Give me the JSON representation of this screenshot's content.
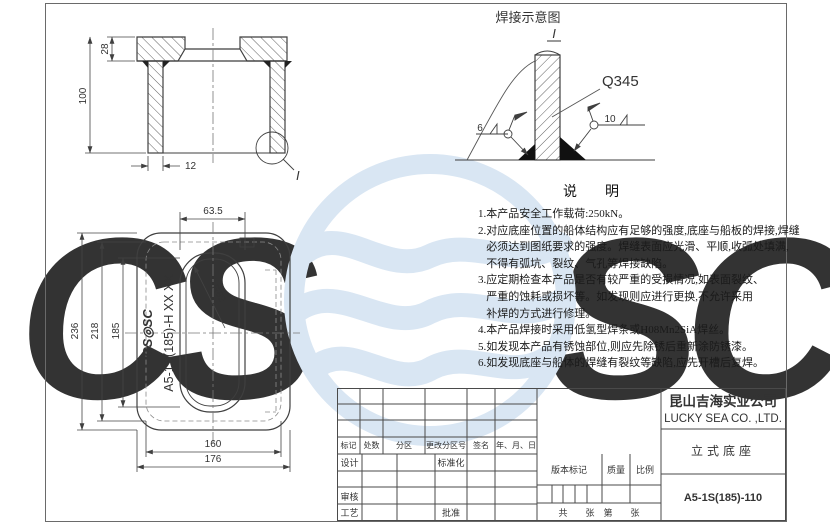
{
  "sheet": {
    "background": "#ffffff",
    "line_color": "#3f3f3f",
    "watermark_color": "#d9e6f3"
  },
  "watermark": {
    "left": "CS",
    "right": "SC"
  },
  "section_view": {
    "dim_flange": "28",
    "dim_height": "100",
    "dim_wall": "12",
    "detail_label": "I"
  },
  "plan_view": {
    "dim_slot_width": "63.5",
    "radius_label": "R62",
    "dim_outer_height": "236",
    "dim_mid_height": "218",
    "dim_inner_height": "185",
    "dim_inner_width": "160",
    "dim_outer_width": "176",
    "logo_text": "CS◎SC",
    "part_code": "A5-1S(185)-H XX XX"
  },
  "weld_diagram": {
    "title": "焊接示意图",
    "detail_label": "I",
    "material_label": "Q345",
    "left_weld_size": "6",
    "right_weld_size": "10"
  },
  "notes": {
    "title": "说　　明",
    "lines": [
      "1.本产品安全工作载荷:250kN。",
      "2.对应底座位置的船体结构应有足够的强度,底座与船板的焊接,焊缝",
      "   必须达到图纸要求的强度。焊缝表面应光滑、平顺,收弧处填满,",
      "   不得有弧坑、裂纹、气孔等焊接缺陷。",
      "3.应定期检查本产品是否有较严重的受损情况,如表面裂纹、",
      "   严重的蚀耗或损坏等。如发现则应进行更换,不允许采用",
      "   补焊的方式进行修理。",
      "4.本产品焊接时采用低氢型焊条或H08Mn2SiA焊丝。",
      "5.如发现本产品有锈蚀部位,则应先除锈后重新涂防锈漆。",
      "6.如发现底座与船体的焊缝有裂纹等缺陷,应先开槽后复焊。"
    ]
  },
  "title_block": {
    "rev": {
      "mark": "标记",
      "count": "处数",
      "zone": "分区",
      "change_no": "更改分区号",
      "sign": "签名",
      "date": "年、月、日"
    },
    "roles": {
      "design": "设计",
      "standardize": "标准化",
      "check": "审核",
      "process": "工艺",
      "approve": "批准"
    },
    "meta": {
      "version": "版本标记",
      "weight": "质量",
      "scale": "比例",
      "sheets": "共　　张　第　　张"
    },
    "company_cn": "昆山吉海实业公司",
    "company_en": "LUCKY SEA CO. ,LTD.",
    "product_name": "立式底座",
    "drawing_no": "A5-1S(185)-110"
  }
}
